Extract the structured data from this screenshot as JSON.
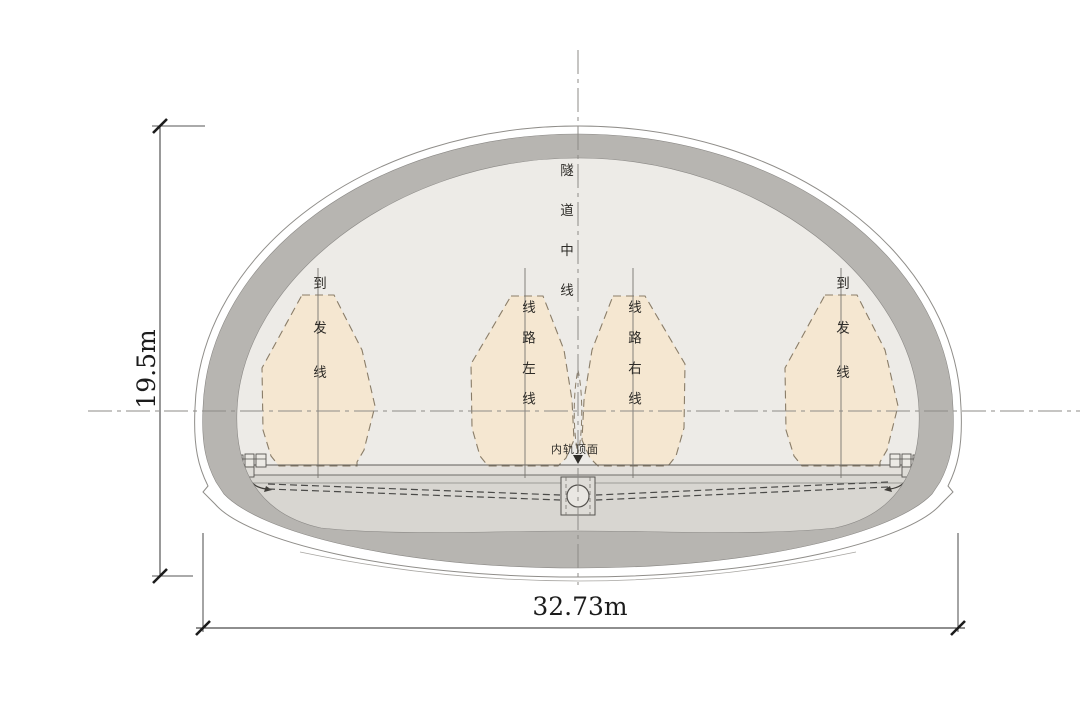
{
  "drawing": {
    "type": "tunnel-cross-section",
    "centerline_label": "隧道中线",
    "rail_top_label": "内轨顶面",
    "envelopes": [
      {
        "label": "到发线"
      },
      {
        "label": "线路左线"
      },
      {
        "label": "线路右线"
      },
      {
        "label": "到发线"
      }
    ],
    "dimensions": {
      "height": "19.5m",
      "width": "32.73m"
    },
    "colors": {
      "interior": "#edebe7",
      "lining": "#b7b5b1",
      "below_track": "#d8d6d1",
      "track_slab": "#e3e0db",
      "envelope_fill": "#f5e7d1",
      "dimension_ink": "#1c1c1c"
    }
  }
}
